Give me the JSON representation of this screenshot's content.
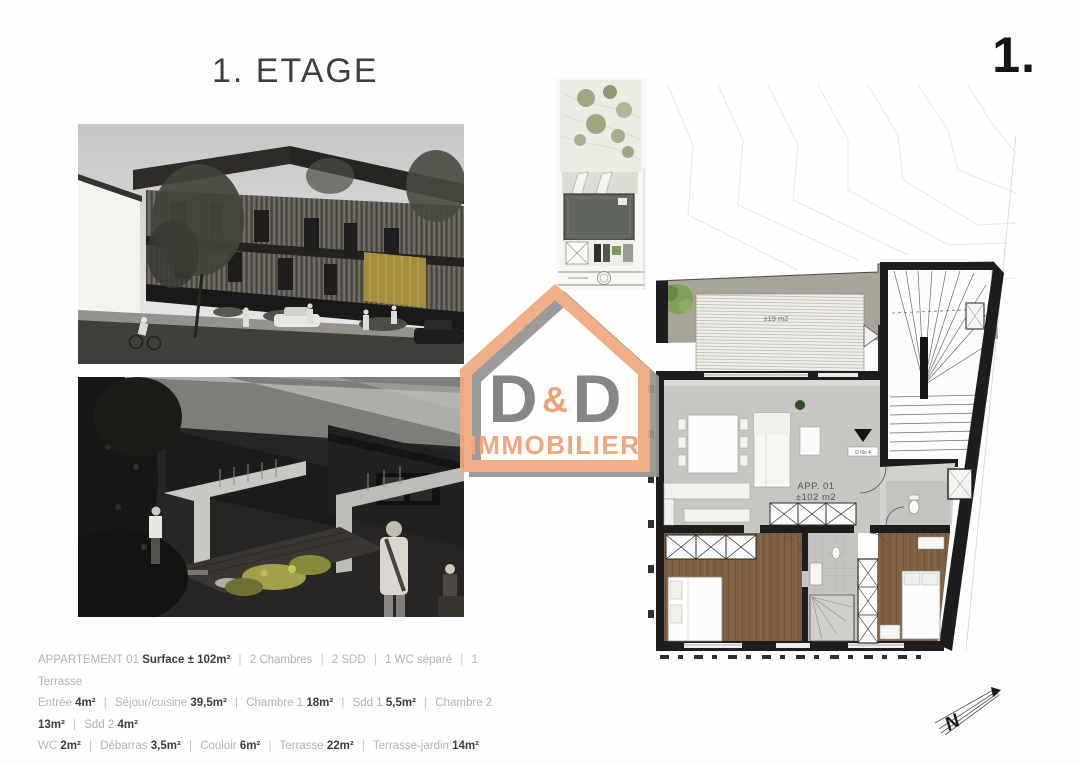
{
  "page": {
    "title": "1. ETAGE",
    "page_number": "1."
  },
  "logo": {
    "letter_left": "D",
    "ampersand": "&",
    "letter_right": "D",
    "word": "IMMOBILIER",
    "orange": "#f2a87e",
    "gray": "#8a8a8a"
  },
  "floor_plan": {
    "terrace_area_label": "±19 m2",
    "small_terrace_label": "±7.8 m2",
    "apartment_name": "APP. 01",
    "apartment_area": "±102 m2",
    "door_tag": "D No 4"
  },
  "north_arrow": {
    "letter": "N"
  },
  "details": {
    "separator": "|",
    "line1": {
      "prefix": "APPARTEMENT 01",
      "surface_label": "Surface ± 102m²",
      "features": [
        "2 Chambres",
        "2 SDD",
        "1 WC séparé",
        "1 Terrasse"
      ]
    },
    "line2": [
      {
        "label": "Entrée",
        "value": "4m²"
      },
      {
        "label": "Séjour/cuisine",
        "value": "39,5m²"
      },
      {
        "label": "Chambre 1",
        "value": "18m²"
      },
      {
        "label": "Sdd 1",
        "value": "5,5m²"
      },
      {
        "label": "Chambre 2",
        "value": "13m²"
      },
      {
        "label": "Sdd 2",
        "value": "4m²"
      }
    ],
    "line3": [
      {
        "label": "WC",
        "value": "2m²"
      },
      {
        "label": "Débarras",
        "value": "3,5m²"
      },
      {
        "label": "Couloir",
        "value": "6m²"
      },
      {
        "label": "Terrasse",
        "value": "22m²"
      },
      {
        "label": "Terrasse-jardin",
        "value": "14m²"
      }
    ]
  }
}
